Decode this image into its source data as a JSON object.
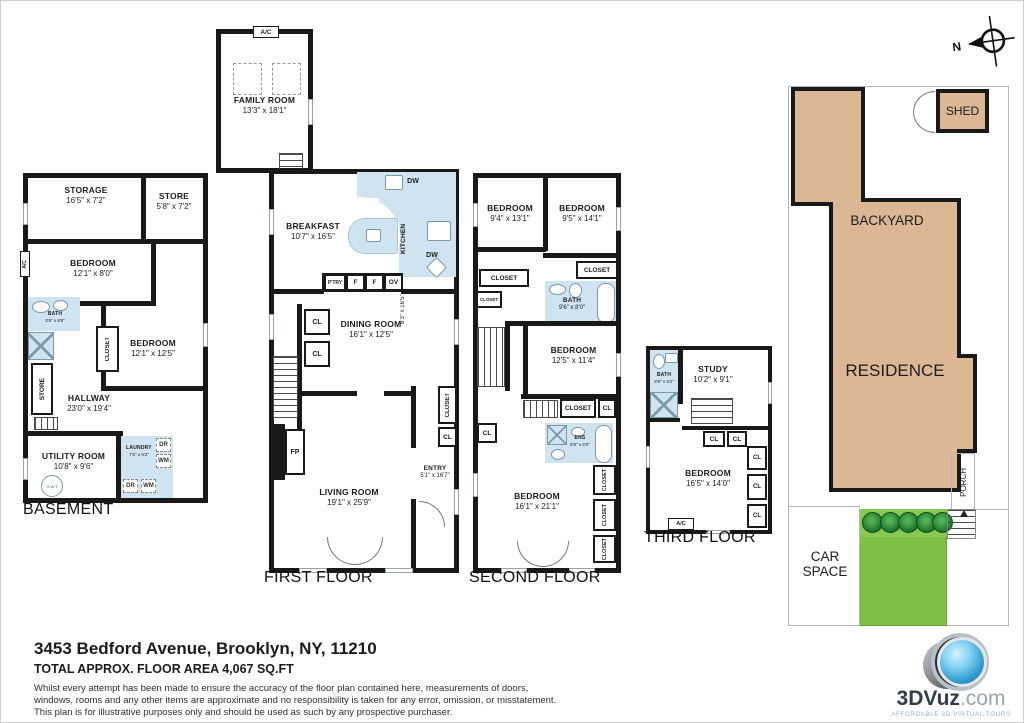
{
  "compass": {
    "label": "N"
  },
  "basement": {
    "title": "BASEMENT",
    "storage": {
      "name": "STORAGE",
      "dims": "16'5\" x 7'2\""
    },
    "store_top": {
      "name": "STORE",
      "dims": "5'8\" x 7'2\""
    },
    "bedroom1": {
      "name": "BEDROOM",
      "dims": "12'1\" x 8'0\""
    },
    "bath": {
      "name": "BATH",
      "dims": "3'8\" x 8'8\""
    },
    "closet": "CLOSET",
    "store_side": "STORE",
    "ac": "A/C",
    "bedroom2": {
      "name": "BEDROOM",
      "dims": "12'1\" x 12'5\""
    },
    "hallway": {
      "name": "HALLWAY",
      "dims": "23'0\" x 19'4\""
    },
    "utility": {
      "name": "UTILITY ROOM",
      "dims": "10'8\" x 9'6\""
    },
    "hwt": "H.W.T",
    "laundry": {
      "name": "LAUNDRY",
      "dims": "7'5\" x 9'2\""
    },
    "dr1": "DR",
    "wm1": "WM",
    "dr2": "DR",
    "wm2": "WM"
  },
  "first": {
    "title": "FIRST FLOOR",
    "ac": "A/C",
    "family": {
      "name": "FAMILY ROOM",
      "dims": "13'3\" x 18'1\""
    },
    "breakfast": {
      "name": "BREAKFAST",
      "dims": "10'7\" x 16'5\""
    },
    "kitchen": {
      "name": "KITCHEN",
      "dims": "6'3\" x 16'5\""
    },
    "dw1": "DW",
    "dw2": "DW",
    "ptry": "P'TRY",
    "f1": "F",
    "f2": "F",
    "ov": "OV",
    "dining": {
      "name": "DINING ROOM",
      "dims": "16'1\" x 12'5\""
    },
    "cl1": "CL",
    "cl2": "CL",
    "cl3": "CL",
    "closet": "CLOSET",
    "fp": "FP",
    "living": {
      "name": "LIVING ROOM",
      "dims": "19'1\" x 25'9\""
    },
    "entry": {
      "name": "ENTRY",
      "dims": "5'1\" x 16'7\""
    }
  },
  "second": {
    "title": "SECOND FLOOR",
    "bedroom1": {
      "name": "BEDROOM",
      "dims": "9'4\" x 13'1\""
    },
    "bedroom2": {
      "name": "BEDROOM",
      "dims": "9'5\" x 14'1\""
    },
    "closet1": "CLOSET",
    "closet2": "CLOSET",
    "closet3": "CLOSET",
    "bath": {
      "name": "BATH",
      "dims": "9'6\" x 8'0\""
    },
    "bedroom3": {
      "name": "BEDROOM",
      "dims": "12'5\" x 11'4\""
    },
    "closet4": "CLOSET",
    "cl1": "CL",
    "cl2": "CL",
    "ens": {
      "name": "ENS",
      "dims": "9'8\" x 6'0\""
    },
    "bedroom4": {
      "name": "BEDROOM",
      "dims": "16'1\" x 21'1\""
    },
    "closet5": "CLOSET",
    "closet6": "CLOSET",
    "closet7": "CLOSET"
  },
  "third": {
    "title": "THIRD FLOOR",
    "bath": {
      "name": "BATH",
      "dims": "3'9\" x 9'2\""
    },
    "study": {
      "name": "STUDY",
      "dims": "10'2\" x 9'1\""
    },
    "cl1": "CL",
    "cl2": "CL",
    "cl3": "CL",
    "cl4": "CL",
    "cl5": "CL",
    "bedroom": {
      "name": "BEDROOM",
      "dims": "16'5\" x 14'0\""
    },
    "ac": "A/C"
  },
  "site": {
    "shed": "SHED",
    "backyard": "BACKYARD",
    "residence": "RESIDENCE",
    "porch": "PORCH",
    "car_space": "CAR SPACE"
  },
  "footer": {
    "address": "3453 Bedford Avenue, Brooklyn, NY, 11210",
    "area": "TOTAL APPROX. FLOOR AREA 4,067 SQ.FT",
    "disclaimer1": "Whilst every attempt has been made to ensure the accuracy of the floor plan contained here, measurements of doors,",
    "disclaimer2": "windows, rooms and any other items are approximate and no responsibility is taken for any error, omission, or misstatement.",
    "disclaimer3": "This plan is for illustrative purposes only and should be used as such by any prospective purchaser."
  },
  "logo": {
    "brand": "3DVuz",
    "suffix": ".com",
    "tagline": "AFFORDABLE 3D VIRTUAL TOURS"
  },
  "colors": {
    "wall": "#191919",
    "bath_blue": "#cfe4f0",
    "residence_tan": "#dbb795",
    "lawn_green": "#7cc142",
    "bush_green": "#1e7a2e"
  }
}
